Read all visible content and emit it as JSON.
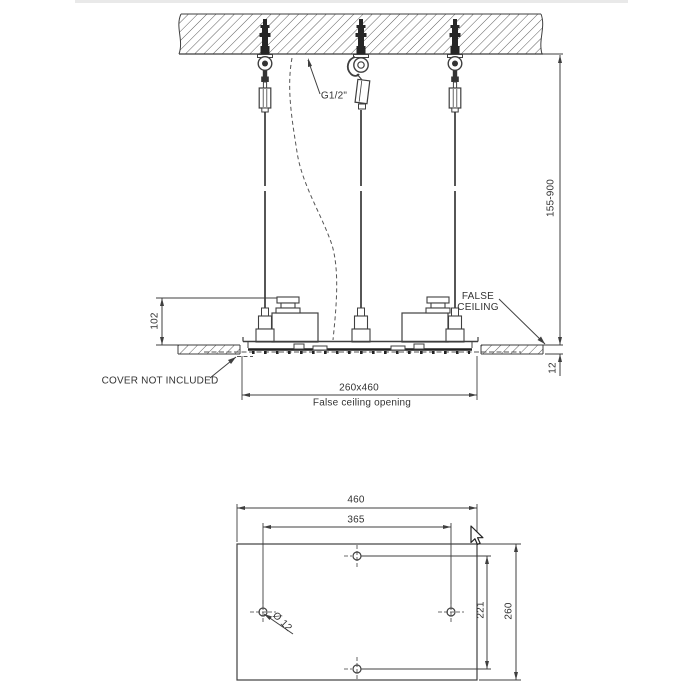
{
  "drawing": {
    "title": "Ceiling-mounted shower head installation drawing",
    "colors": {
      "line": "#3f3f3f",
      "dark_fill": "#262626",
      "background": "#ffffff",
      "top_strip": "#e9e9e9"
    },
    "side_view": {
      "thread_label": "G1/2\"",
      "height_range": "155-900",
      "false_ceiling_label": "FALSE CEILING",
      "headbox_height": "102",
      "panel_thickness": "12",
      "opening_size": "260x460",
      "opening_caption": "False ceiling opening",
      "cover_note": "COVER NOT INCLUDED"
    },
    "plan_view": {
      "width": "460",
      "hole_spacing_width": "365",
      "depth": "260",
      "hole_spacing_depth": "221",
      "hole_diameter": "Ø 12"
    }
  }
}
